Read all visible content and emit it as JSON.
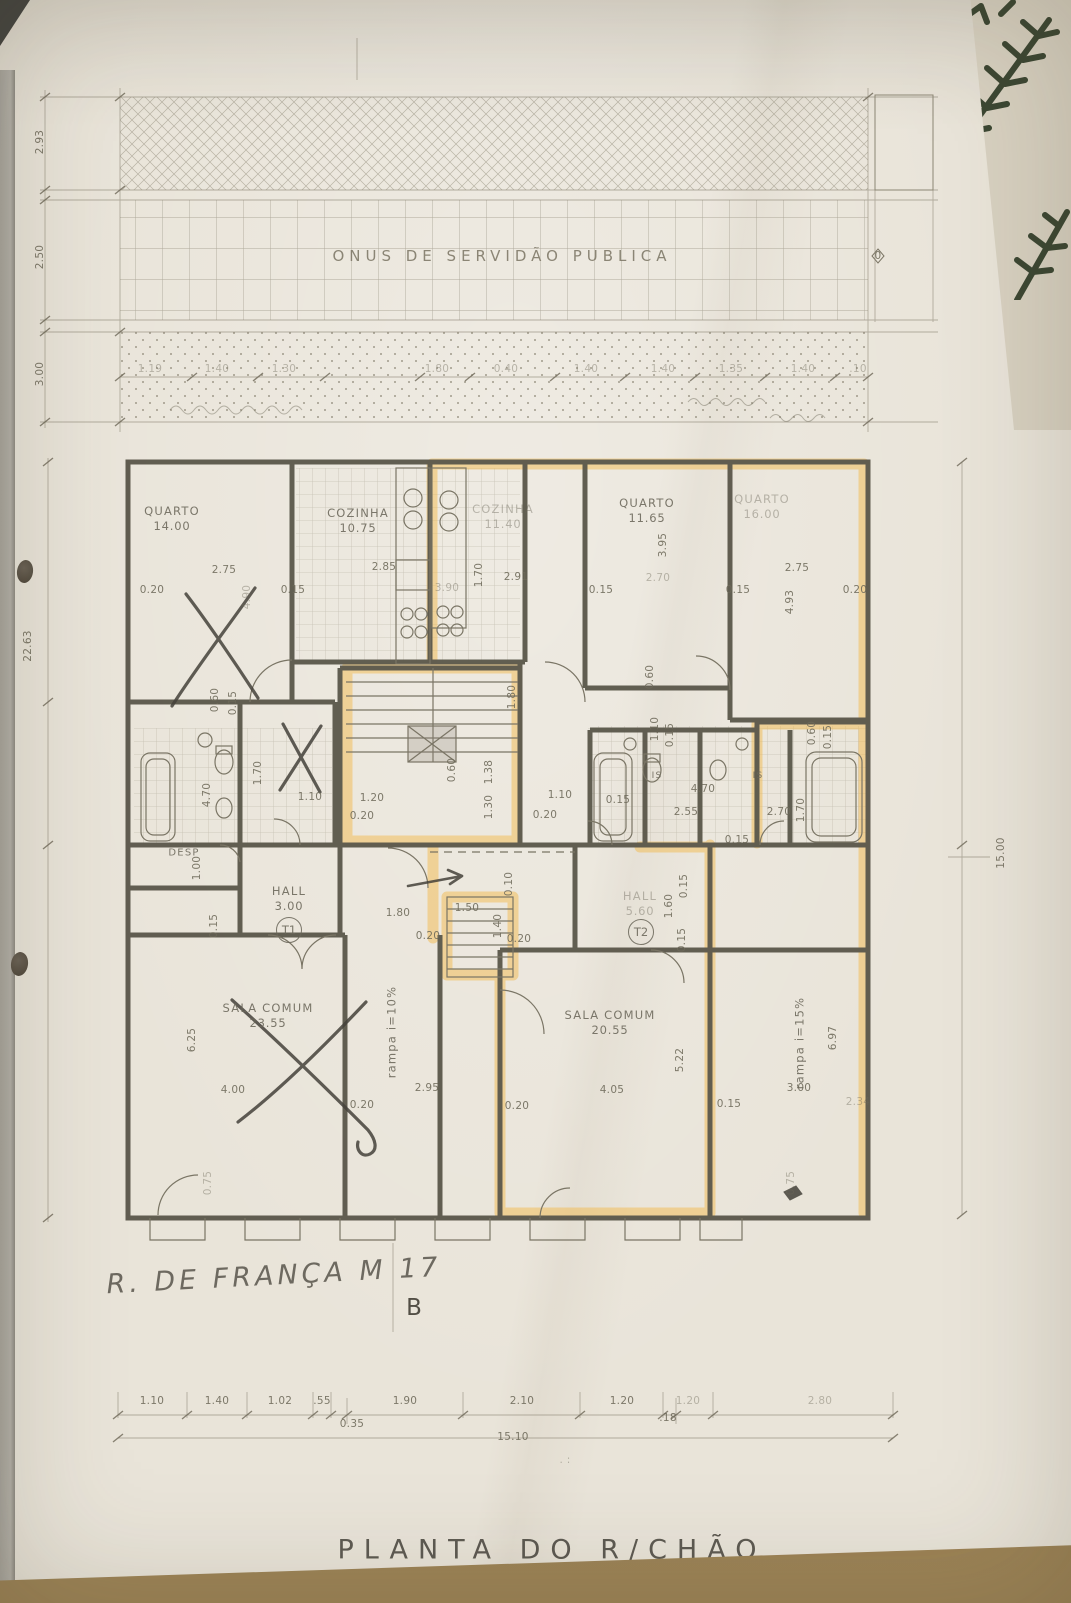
{
  "annotations": {
    "servidao": "ONUS DE SERVIDÃO PUBLICA",
    "street": "R. DE FRANÇA M 17",
    "section_letter": "B",
    "plan_title": "PLANTA DO R/CHÃO",
    "zero_marker": "0"
  },
  "colors": {
    "paper": "#e9e4d9",
    "pencil": "#6d6959",
    "wall": "#57534a",
    "highlight": "#f2b94e",
    "table": "#97794d",
    "plant": "#3c4733",
    "hand": "#4f4b42",
    "tile": "#a19b89"
  },
  "rooms": [
    {
      "name": "room-quarto-1",
      "l1": "QUARTO",
      "l2": "14.00",
      "x": 172,
      "y": 519
    },
    {
      "name": "room-cozinha-1",
      "l1": "COZINHA",
      "l2": "10.75",
      "x": 358,
      "y": 521
    },
    {
      "name": "room-cozinha-2",
      "l1": "COZINHA",
      "l2": "11.40",
      "x": 503,
      "y": 517,
      "f": 1
    },
    {
      "name": "room-quarto-2",
      "l1": "QUARTO",
      "l2": "11.65",
      "x": 647,
      "y": 511
    },
    {
      "name": "room-quarto-3",
      "l1": "QUARTO",
      "l2": "16.00",
      "x": 762,
      "y": 507,
      "f": 1
    },
    {
      "name": "room-desp",
      "l1": "DESP",
      "x": 184,
      "y": 853,
      "s": 10
    },
    {
      "name": "room-hall-t1",
      "l1": "HALL",
      "l2": "3.00",
      "x": 289,
      "y": 899
    },
    {
      "name": "unit-t1",
      "l1": "T1",
      "x": 289,
      "y": 930,
      "circle": 1
    },
    {
      "name": "room-hall-t2",
      "l1": "HALL",
      "l2": "5.60",
      "x": 640,
      "y": 904,
      "f": 1
    },
    {
      "name": "unit-t2",
      "l1": "T2",
      "x": 641,
      "y": 932,
      "circle": 1
    },
    {
      "name": "room-is-1",
      "l1": "IS",
      "x": 657,
      "y": 777,
      "s": 9
    },
    {
      "name": "room-is-2",
      "l1": "IS",
      "x": 758,
      "y": 777,
      "s": 9
    },
    {
      "name": "room-sala-1",
      "l1": "SALA COMUM",
      "l2": "23.55",
      "x": 268,
      "y": 1016
    },
    {
      "name": "room-sala-2",
      "l1": "SALA COMUM",
      "l2": "20.55",
      "x": 610,
      "y": 1023
    },
    {
      "name": "ramp-10",
      "l1": "rampa i=10%",
      "x": 392,
      "y": 1032,
      "r": -90
    },
    {
      "name": "ramp-15",
      "l1": "rampa i=15%",
      "x": 800,
      "y": 1043,
      "r": -90
    }
  ],
  "dims": [
    {
      "t": "2.93",
      "x": 40,
      "y": 142,
      "r": -90
    },
    {
      "t": "2.50",
      "x": 40,
      "y": 257,
      "r": -90
    },
    {
      "t": "3.00",
      "x": 40,
      "y": 374,
      "r": -90
    },
    {
      "t": "22.63",
      "x": 28,
      "y": 646,
      "r": -90
    },
    {
      "t": "15.00",
      "x": 1001,
      "y": 853,
      "r": -90
    },
    {
      "t": "1.19",
      "x": 150,
      "y": 369,
      "f": 1
    },
    {
      "t": "1.40",
      "x": 217,
      "y": 369,
      "f": 1
    },
    {
      "t": "1.30",
      "x": 284,
      "y": 369,
      "f": 1
    },
    {
      "t": "1.80",
      "x": 437,
      "y": 369,
      "f": 1
    },
    {
      "t": "0.40",
      "x": 506,
      "y": 369,
      "f": 1
    },
    {
      "t": "1.40",
      "x": 586,
      "y": 369,
      "f": 1
    },
    {
      "t": "1.40",
      "x": 663,
      "y": 369,
      "f": 1
    },
    {
      "t": "1.35",
      "x": 731,
      "y": 369,
      "f": 1
    },
    {
      "t": "1.40",
      "x": 803,
      "y": 369,
      "f": 1
    },
    {
      "t": ".10",
      "x": 858,
      "y": 369,
      "f": 1
    },
    {
      "t": "0",
      "x": 878,
      "y": 256
    },
    {
      "t": "0.20",
      "x": 152,
      "y": 590
    },
    {
      "t": "2.75",
      "x": 224,
      "y": 570
    },
    {
      "t": "4.90",
      "x": 247,
      "y": 597,
      "r": -90,
      "f": 1
    },
    {
      "t": "0.15",
      "x": 293,
      "y": 590
    },
    {
      "t": "2.85",
      "x": 384,
      "y": 567
    },
    {
      "t": "3.90",
      "x": 447,
      "y": 588,
      "f": 1
    },
    {
      "t": "1.70",
      "x": 479,
      "y": 575,
      "r": -90
    },
    {
      "t": "2.91",
      "x": 516,
      "y": 577
    },
    {
      "t": "0.15",
      "x": 601,
      "y": 590
    },
    {
      "t": "3.95",
      "x": 663,
      "y": 545,
      "r": -90
    },
    {
      "t": "2.70",
      "x": 658,
      "y": 578,
      "f": 1
    },
    {
      "t": "0.15",
      "x": 738,
      "y": 590
    },
    {
      "t": "2.75",
      "x": 797,
      "y": 568
    },
    {
      "t": "0.20",
      "x": 855,
      "y": 590
    },
    {
      "t": "4.93",
      "x": 790,
      "y": 602,
      "r": -90
    },
    {
      "t": "0.60",
      "x": 215,
      "y": 700,
      "r": -90
    },
    {
      "t": "0.15",
      "x": 233,
      "y": 703,
      "r": -90
    },
    {
      "t": "0.60",
      "x": 650,
      "y": 677,
      "r": -90
    },
    {
      "t": "1.10",
      "x": 655,
      "y": 729,
      "r": -90
    },
    {
      "t": "0.15",
      "x": 670,
      "y": 735,
      "r": -90
    },
    {
      "t": "0.60",
      "x": 812,
      "y": 733,
      "r": -90
    },
    {
      "t": "0.15",
      "x": 828,
      "y": 737,
      "r": -90
    },
    {
      "t": "4.70",
      "x": 207,
      "y": 795,
      "r": -90
    },
    {
      "t": "1.70",
      "x": 258,
      "y": 773,
      "r": -90
    },
    {
      "t": "1.10",
      "x": 310,
      "y": 797
    },
    {
      "t": "1.20",
      "x": 372,
      "y": 798
    },
    {
      "t": "0.20",
      "x": 362,
      "y": 816
    },
    {
      "t": "1.80",
      "x": 512,
      "y": 697,
      "r": -90
    },
    {
      "t": "0.60",
      "x": 452,
      "y": 770,
      "r": -90
    },
    {
      "t": "1.38",
      "x": 489,
      "y": 772,
      "r": -90
    },
    {
      "t": "1.30",
      "x": 489,
      "y": 807,
      "r": -90
    },
    {
      "t": "1.10",
      "x": 560,
      "y": 795
    },
    {
      "t": "0.20",
      "x": 545,
      "y": 815
    },
    {
      "t": "0.15",
      "x": 618,
      "y": 800
    },
    {
      "t": "2.55",
      "x": 686,
      "y": 812
    },
    {
      "t": "4.70",
      "x": 703,
      "y": 789
    },
    {
      "t": "2.70",
      "x": 779,
      "y": 812
    },
    {
      "t": "1.70",
      "x": 801,
      "y": 810,
      "r": -90
    },
    {
      "t": "0.15",
      "x": 737,
      "y": 840
    },
    {
      "t": "1.00",
      "x": 197,
      "y": 868,
      "r": -90
    },
    {
      "t": "0.15",
      "x": 214,
      "y": 926,
      "r": -90
    },
    {
      "t": "1.80",
      "x": 398,
      "y": 913
    },
    {
      "t": "0.20",
      "x": 428,
      "y": 936
    },
    {
      "t": "1.50",
      "x": 467,
      "y": 908
    },
    {
      "t": "0.10",
      "x": 509,
      "y": 884,
      "r": -90
    },
    {
      "t": "1.40",
      "x": 498,
      "y": 926,
      "r": -90
    },
    {
      "t": "0.20",
      "x": 519,
      "y": 939
    },
    {
      "t": "1.60",
      "x": 669,
      "y": 906,
      "r": -90
    },
    {
      "t": "0.15",
      "x": 684,
      "y": 886,
      "r": -90
    },
    {
      "t": "0.15",
      "x": 682,
      "y": 940,
      "r": -90
    },
    {
      "t": "6.25",
      "x": 192,
      "y": 1040,
      "r": -90
    },
    {
      "t": "4.00",
      "x": 233,
      "y": 1090
    },
    {
      "t": "0.75",
      "x": 208,
      "y": 1183,
      "r": -90,
      "f": 1
    },
    {
      "t": "0.20",
      "x": 362,
      "y": 1105
    },
    {
      "t": "2.95",
      "x": 427,
      "y": 1088
    },
    {
      "t": "0.20",
      "x": 517,
      "y": 1106
    },
    {
      "t": "4.05",
      "x": 612,
      "y": 1090
    },
    {
      "t": "5.22",
      "x": 680,
      "y": 1060,
      "r": -90
    },
    {
      "t": "0.15",
      "x": 729,
      "y": 1104
    },
    {
      "t": "3.00",
      "x": 799,
      "y": 1088
    },
    {
      "t": "6.97",
      "x": 833,
      "y": 1038,
      "r": -90
    },
    {
      "t": "0.75",
      "x": 791,
      "y": 1183,
      "r": -90,
      "f": 1
    },
    {
      "t": "2.34",
      "x": 858,
      "y": 1102,
      "f": 1
    },
    {
      "t": "1.10",
      "x": 152,
      "y": 1401
    },
    {
      "t": "1.40",
      "x": 217,
      "y": 1401
    },
    {
      "t": "1.02",
      "x": 280,
      "y": 1401
    },
    {
      "t": ".55",
      "x": 322,
      "y": 1401
    },
    {
      "t": "1.90",
      "x": 405,
      "y": 1401
    },
    {
      "t": "2.10",
      "x": 522,
      "y": 1401
    },
    {
      "t": "1.20",
      "x": 622,
      "y": 1401
    },
    {
      "t": "1.20",
      "x": 688,
      "y": 1401,
      "f": 1
    },
    {
      "t": "2.80",
      "x": 820,
      "y": 1401,
      "f": 1
    },
    {
      "t": "0.35",
      "x": 352,
      "y": 1424
    },
    {
      "t": ".18",
      "x": 668,
      "y": 1418
    },
    {
      "t": "15.10",
      "x": 513,
      "y": 1437
    },
    {
      "t": ". :",
      "x": 565,
      "y": 1460,
      "f": 1
    }
  ]
}
